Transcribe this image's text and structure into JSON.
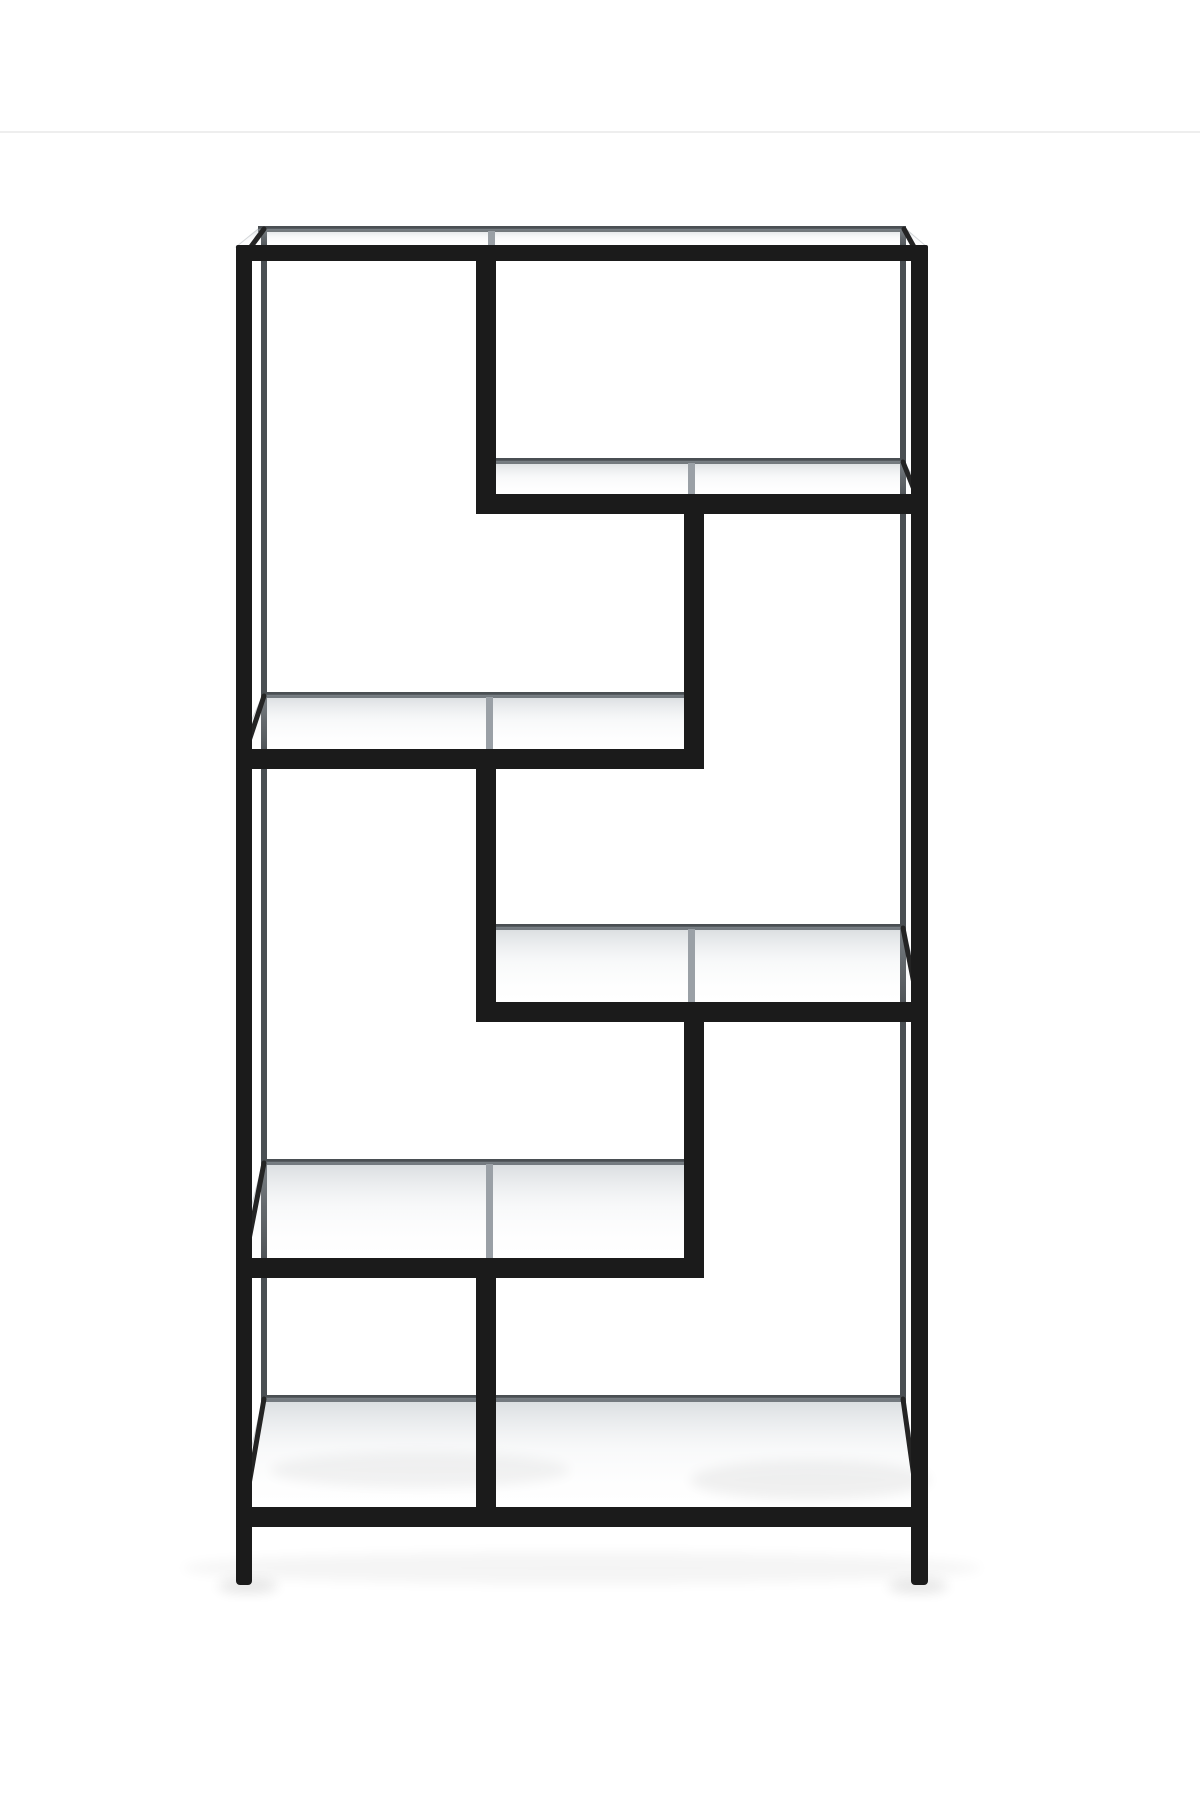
{
  "image": {
    "kind": "product-photo",
    "subject": "Black metal etagere bookcase with clear tempered glass shelves arranged in an asymmetric greek-key pattern, photographed on a plain white studio background",
    "background_color": "#ffffff",
    "seam_line": {
      "y": 131,
      "color": "#ebebeb",
      "opacity": 0.85
    }
  },
  "palette": {
    "frame_front": "#1b1b1b",
    "frame_front_soft": "#242424",
    "frame_back": "#4a4f53",
    "through_glass_post": "#9aa0a6",
    "glass_tint_back": "rgba(168,176,183,0.45)",
    "glass_tint_mid": "rgba(215,220,224,0.18)",
    "glass_tint_front": "rgba(255,255,255,0.02)",
    "shadow": "#000000"
  },
  "geometry": {
    "canvas": {
      "width": 1200,
      "height": 1800
    },
    "shadows": [
      {
        "name": "floor-shadow-wide",
        "cx": 582,
        "cy": 1568,
        "rx": 400,
        "ry": 16,
        "opacity": 0.04
      },
      {
        "name": "foot-shadow-left",
        "cx": 248,
        "cy": 1586,
        "rx": 30,
        "ry": 7,
        "opacity": 0.1
      },
      {
        "name": "foot-shadow-right",
        "cx": 918,
        "cy": 1586,
        "rx": 30,
        "ry": 7,
        "opacity": 0.1
      },
      {
        "name": "glass-floor-shadow-left",
        "cx": 420,
        "cy": 1470,
        "rx": 150,
        "ry": 18,
        "opacity": 0.05
      },
      {
        "name": "glass-floor-shadow-right",
        "cx": 810,
        "cy": 1480,
        "rx": 120,
        "ry": 20,
        "opacity": 0.06
      }
    ],
    "back_frame": [
      {
        "name": "back-top-rail",
        "x": 258,
        "y": 226,
        "w": 648,
        "h": 6
      },
      {
        "name": "back-leg-left",
        "x": 261,
        "y": 226,
        "w": 6,
        "h": 1175
      },
      {
        "name": "back-leg-right",
        "x": 900,
        "y": 226,
        "w": 6,
        "h": 1175
      },
      {
        "name": "back-shelf-a-rail",
        "x": 489,
        "y": 458,
        "w": 417,
        "h": 6
      },
      {
        "name": "back-shelf-b-rail",
        "x": 261,
        "y": 692,
        "w": 433,
        "h": 6
      },
      {
        "name": "back-shelf-c-rail",
        "x": 489,
        "y": 924,
        "w": 417,
        "h": 6
      },
      {
        "name": "back-shelf-d-rail",
        "x": 261,
        "y": 1159,
        "w": 433,
        "h": 6
      },
      {
        "name": "back-base-rail",
        "x": 261,
        "y": 1395,
        "w": 645,
        "h": 7
      },
      {
        "name": "back-divider-1",
        "x": 489,
        "y": 226,
        "w": 6,
        "h": 238
      },
      {
        "name": "back-divider-2",
        "x": 688,
        "y": 458,
        "w": 6,
        "h": 240
      },
      {
        "name": "back-divider-3",
        "x": 487,
        "y": 692,
        "w": 6,
        "h": 238
      },
      {
        "name": "back-divider-4",
        "x": 688,
        "y": 924,
        "w": 6,
        "h": 241
      },
      {
        "name": "back-divider-5",
        "x": 487,
        "y": 1159,
        "w": 6,
        "h": 242
      }
    ],
    "glass_panels": [
      {
        "name": "glass-top",
        "points": "258,229 906,229 927,247 236,247"
      },
      {
        "name": "glass-shelf-a",
        "points": "492,461 903,461 927,497 478,497"
      },
      {
        "name": "glass-shelf-b",
        "points": "263,695 691,695 702,752 237,752"
      },
      {
        "name": "glass-shelf-c",
        "points": "492,927 903,927 927,1005 478,1005"
      },
      {
        "name": "glass-shelf-d",
        "points": "263,1162 691,1162 702,1261 237,1261"
      },
      {
        "name": "glass-bottom",
        "points": "263,1398 903,1398 927,1510 237,1510"
      }
    ],
    "through_glass_posts": [
      {
        "name": "seen-post-divider-1",
        "x": 488,
        "y": 231,
        "w": 7,
        "h": 15
      },
      {
        "name": "seen-post-divider-2",
        "x": 688,
        "y": 463,
        "w": 7,
        "h": 32
      },
      {
        "name": "seen-post-divider-3",
        "x": 486,
        "y": 697,
        "w": 7,
        "h": 53
      },
      {
        "name": "seen-post-divider-4",
        "x": 688,
        "y": 929,
        "w": 7,
        "h": 74
      },
      {
        "name": "seen-post-divider-5",
        "x": 486,
        "y": 1164,
        "w": 7,
        "h": 95
      }
    ],
    "depth_edges": [
      {
        "name": "depth-top-left",
        "x1": 244,
        "y1": 256,
        "x2": 264,
        "y2": 229
      },
      {
        "name": "depth-top-right",
        "x1": 919,
        "y1": 256,
        "x2": 904,
        "y2": 229
      },
      {
        "name": "depth-a-left",
        "x1": 486,
        "y1": 502,
        "x2": 492,
        "y2": 462
      },
      {
        "name": "depth-a-right",
        "x1": 919,
        "y1": 502,
        "x2": 903,
        "y2": 462
      },
      {
        "name": "depth-b-left",
        "x1": 244,
        "y1": 756,
        "x2": 264,
        "y2": 696
      },
      {
        "name": "depth-b-right",
        "x1": 694,
        "y1": 756,
        "x2": 691,
        "y2": 696
      },
      {
        "name": "depth-c-left",
        "x1": 486,
        "y1": 1009,
        "x2": 492,
        "y2": 928
      },
      {
        "name": "depth-c-right",
        "x1": 919,
        "y1": 1009,
        "x2": 903,
        "y2": 928
      },
      {
        "name": "depth-d-left",
        "x1": 244,
        "y1": 1265,
        "x2": 264,
        "y2": 1163
      },
      {
        "name": "depth-d-right",
        "x1": 694,
        "y1": 1265,
        "x2": 691,
        "y2": 1163
      },
      {
        "name": "depth-base-left",
        "x1": 244,
        "y1": 1513,
        "x2": 264,
        "y2": 1399
      },
      {
        "name": "depth-base-right",
        "x1": 919,
        "y1": 1513,
        "x2": 903,
        "y2": 1399
      }
    ],
    "front_frame": [
      {
        "name": "leg-left",
        "x": 236,
        "y": 245,
        "w": 16,
        "h": 1340,
        "r": 4
      },
      {
        "name": "leg-right",
        "x": 911,
        "y": 245,
        "w": 17,
        "h": 1340,
        "r": 4
      },
      {
        "name": "top-rail",
        "x": 236,
        "y": 245,
        "w": 692,
        "h": 16,
        "r": 2
      },
      {
        "name": "divider-1",
        "x": 476,
        "y": 245,
        "w": 20,
        "h": 269,
        "r": 0
      },
      {
        "name": "shelf-a-rail",
        "x": 476,
        "y": 494,
        "w": 452,
        "h": 20,
        "r": 2
      },
      {
        "name": "divider-2",
        "x": 684,
        "y": 494,
        "w": 20,
        "h": 275,
        "r": 0
      },
      {
        "name": "shelf-b-rail",
        "x": 236,
        "y": 749,
        "w": 468,
        "h": 20,
        "r": 2
      },
      {
        "name": "divider-3",
        "x": 476,
        "y": 749,
        "w": 20,
        "h": 273,
        "r": 0
      },
      {
        "name": "shelf-c-rail",
        "x": 476,
        "y": 1002,
        "w": 452,
        "h": 20,
        "r": 2
      },
      {
        "name": "divider-4",
        "x": 684,
        "y": 1002,
        "w": 20,
        "h": 276,
        "r": 0
      },
      {
        "name": "shelf-d-rail",
        "x": 236,
        "y": 1258,
        "w": 468,
        "h": 20,
        "r": 2
      },
      {
        "name": "divider-5",
        "x": 476,
        "y": 1258,
        "w": 20,
        "h": 269,
        "r": 0
      },
      {
        "name": "base-rail",
        "x": 236,
        "y": 1507,
        "w": 692,
        "h": 20,
        "r": 2
      }
    ]
  }
}
